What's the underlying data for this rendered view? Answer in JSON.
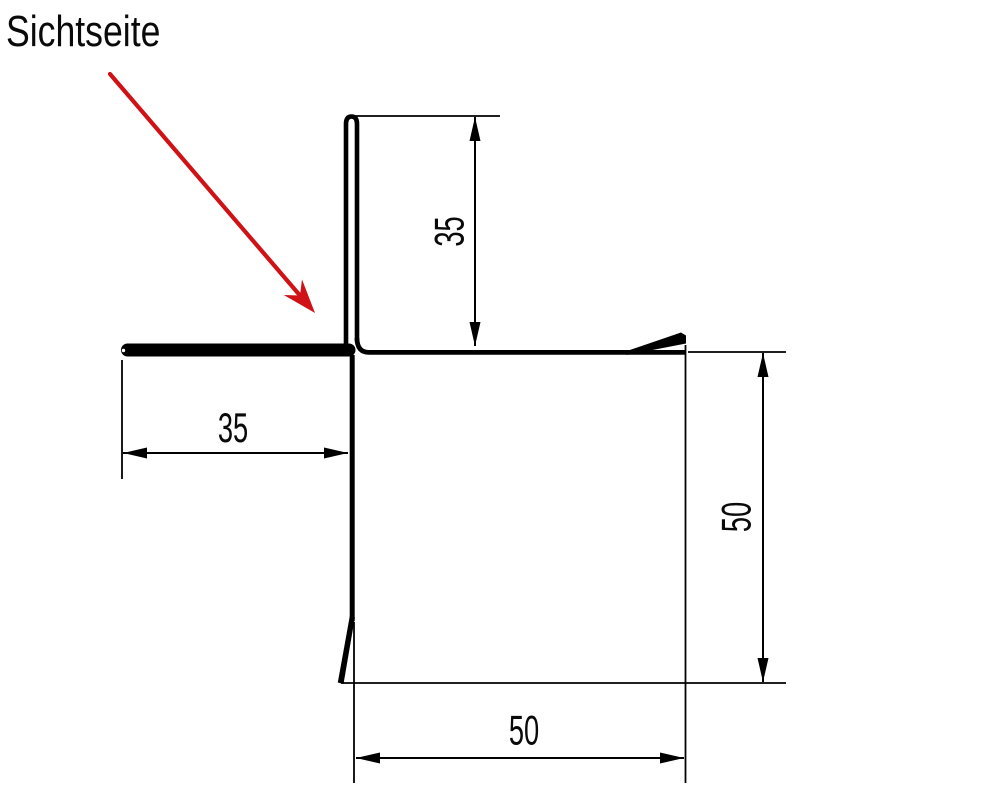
{
  "drawing": {
    "type": "sheet-metal-corner-profile-cross-section",
    "label": "Sichtseite",
    "dimensions": [
      {
        "id": "top-vertical-leg",
        "value": "35",
        "orientation": "vertical"
      },
      {
        "id": "left-horizontal-leg",
        "value": "35",
        "orientation": "horizontal"
      },
      {
        "id": "right-vertical-leg",
        "value": "50",
        "orientation": "vertical"
      },
      {
        "id": "bottom-horizontal-leg",
        "value": "50",
        "orientation": "horizontal"
      }
    ],
    "colors": {
      "arrow_red": "#d01217",
      "label_dark": "#242a2e",
      "line_black": "#000000",
      "background": "#ffffff"
    }
  }
}
